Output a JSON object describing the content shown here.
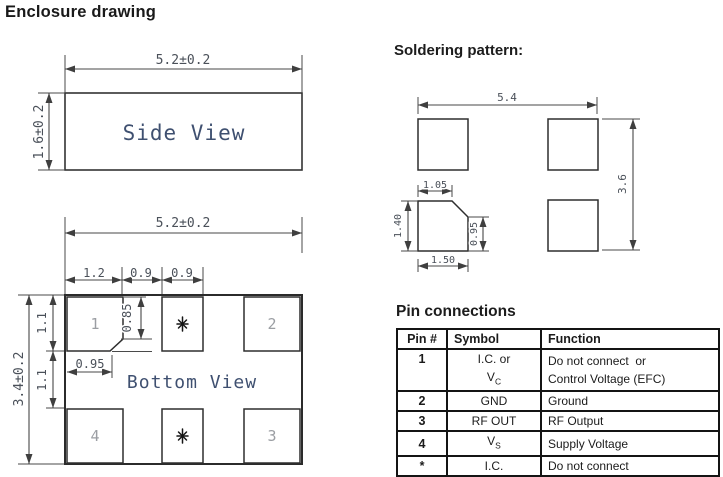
{
  "title": "Enclosure drawing",
  "side_view": {
    "label": "Side View",
    "dim_width": "5.2±0.2",
    "dim_height": "1.6±0.2"
  },
  "bottom_view": {
    "label": "Bottom View",
    "dim_width": "5.2±0.2",
    "dim_height": "3.4±0.2",
    "seg1": "1.2",
    "seg2": "0.9",
    "seg3": "0.9",
    "v1": "1.1",
    "v2": "1.1",
    "chamfer_v": "0.85",
    "chamfer_h": "0.95",
    "pads": {
      "p1": "1",
      "p2": "2",
      "p3": "3",
      "p4": "4",
      "mid_top": "*",
      "mid_bottom": "*"
    }
  },
  "solder": {
    "title": "Soldering pattern:",
    "dim_width": "5.4",
    "dim_height": "3.6",
    "pad_top": "1.05",
    "pad_height": "1.40",
    "chamfer_height": "0.95",
    "pad_width": "1.50"
  },
  "pin_table": {
    "title": "Pin connections",
    "headers": [
      "Pin #",
      "Symbol",
      "Function"
    ],
    "rows": [
      {
        "pin": "1",
        "symbol_line1": "I.C. or",
        "symbol_base": "V",
        "symbol_sub": "C",
        "function": "Do not connect  or\nControl Voltage (EFC)"
      },
      {
        "pin": "2",
        "symbol": "GND",
        "function": "Ground"
      },
      {
        "pin": "3",
        "symbol": "RF OUT",
        "function": "RF Output"
      },
      {
        "pin": "4",
        "symbol_base": "V",
        "symbol_sub": "S",
        "function": "Supply Voltage"
      },
      {
        "pin": "*",
        "symbol": "I.C.",
        "function": "Do not connect"
      }
    ]
  }
}
